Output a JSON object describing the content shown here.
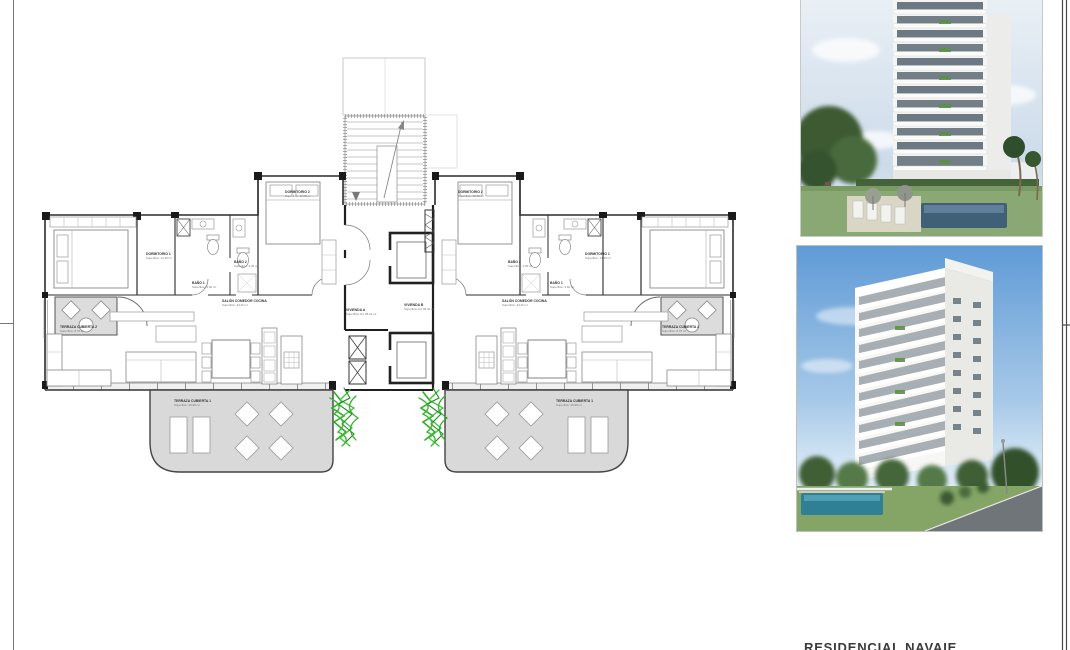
{
  "caption": {
    "title": "RESIDENCIAL NAVAIE"
  },
  "floorplan": {
    "units": {
      "vivienda_a": {
        "name": "VIVIENDA A",
        "area": "Superficie útil: 95,32 m²"
      },
      "vivienda_b": {
        "name": "VIVIENDA B",
        "area": "Superficie útil: 95,32 m²"
      }
    },
    "rooms": {
      "dormitorio1": {
        "name": "DORMITORIO 1",
        "area": "Superficie: 14,45 m²"
      },
      "dormitorio2": {
        "name": "DORMITORIO 2",
        "area": "Superficie: 12,05 m²"
      },
      "banyo1": {
        "name": "BAÑO 1",
        "area": "Superficie: 4,60 m²"
      },
      "banyo2": {
        "name": "BAÑO 2",
        "area": "Superficie: 4,35 m²"
      },
      "salon": {
        "name": "SALÓN COMEDOR COCINA",
        "area": "Superficie: 34,40 m²"
      },
      "terraza1": {
        "name": "TERRAZA CUBIERTA 1",
        "area": "Superficie: 20,98 m²"
      },
      "terraza2": {
        "name": "TERRAZA CUBIERTA 2",
        "area": "Superficie: 8,76 m²"
      }
    }
  },
  "colors": {
    "wall": "#2b2b2b",
    "terrace_gray": "#d9d9d9",
    "plant_green": "#2fae27",
    "sky_blue": "#5f9bd6",
    "pool_teal": "#2f7f95"
  }
}
